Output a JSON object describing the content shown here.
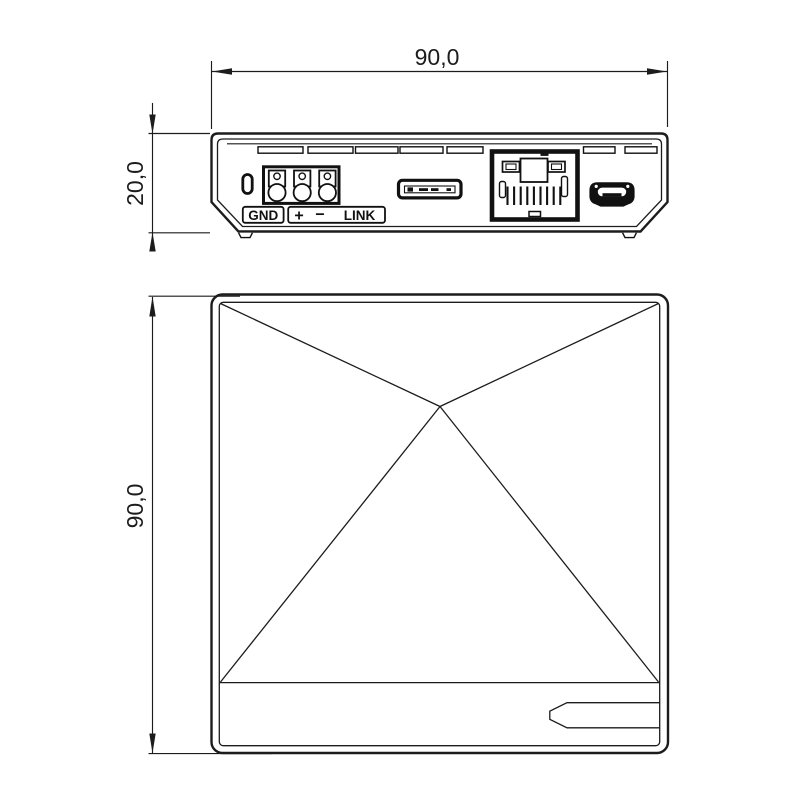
{
  "drawing": {
    "type": "technical-dimension-drawing",
    "units": "mm",
    "colors": {
      "ink": "#1c1c1c",
      "background": "#ffffff"
    },
    "views": {
      "front": {
        "width_dim": "90,0",
        "height_dim": "20,0",
        "ports": {
          "gnd_label": "GND",
          "plus_label": "+",
          "minus_label": "−",
          "link_label": "LINK",
          "components": [
            "status-led",
            "terminal-block-3p",
            "sd-card-slot",
            "rj45-ethernet-jack",
            "micro-usb-port",
            "vent-slots"
          ]
        }
      },
      "top": {
        "height_dim": "90,0",
        "features": [
          "pyramid-apex-facets",
          "label-tab"
        ]
      }
    }
  }
}
